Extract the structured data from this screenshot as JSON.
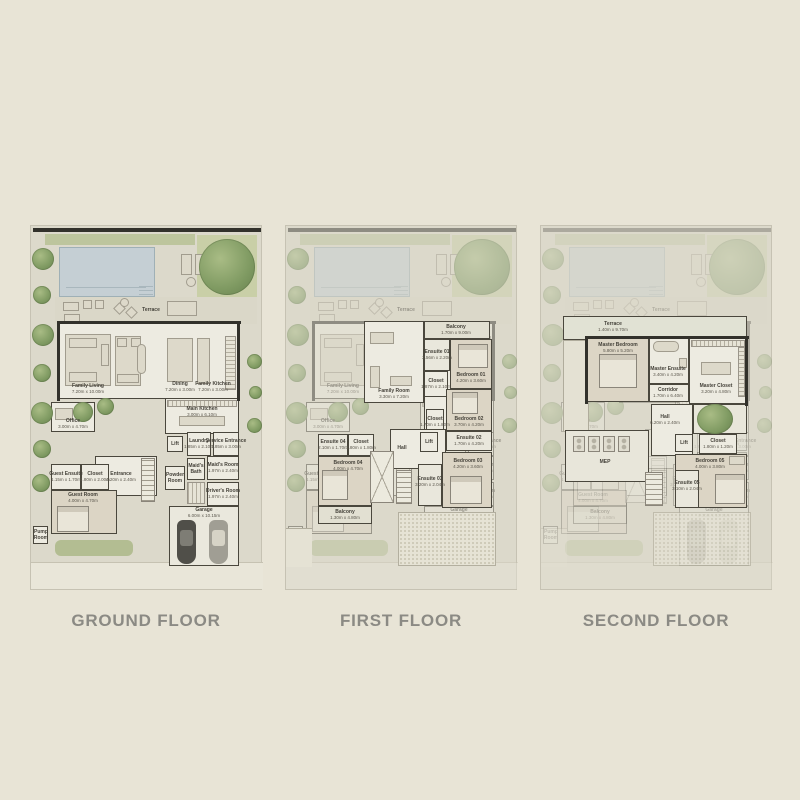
{
  "palette": {
    "page_bg": "#e8e4d6",
    "title_color": "#8b8a84",
    "pool_blue": "#c5cfd4",
    "grass_green": "#c9cfa7",
    "tree_green": "#7f9a62",
    "wall_black": "#32312b",
    "floor_white": "#edebe1",
    "bedroom_tan": "#dcd5c5"
  },
  "floors": {
    "ground": {
      "title": "GROUND FLOOR",
      "rooms": {
        "terrace": {
          "name": "Terrace"
        },
        "family_living": {
          "name": "Family Living",
          "dims": "7.20m x 10.00m"
        },
        "dining": {
          "name": "Dining",
          "dims": "7.20m x 3.00m"
        },
        "family_kitchen": {
          "name": "Family Kitchen",
          "dims": "7.20m x 3.00m"
        },
        "main_kitchen": {
          "name": "Main Kitchen",
          "dims": "3.00m x 6.10m"
        },
        "office": {
          "name": "Office",
          "dims": "3.00m x 4.70m"
        },
        "entrance": {
          "name": "Entrance",
          "dims": "4.20m x 2.40m"
        },
        "guest_ensuite": {
          "name": "Guest Ensuite",
          "dims": "1.15m x 1.70m"
        },
        "closet": {
          "name": "Closet",
          "dims": "1.80m x 2.00m"
        },
        "guest_room": {
          "name": "Guest Room",
          "dims": "4.00m x 4.70m"
        },
        "lift": {
          "name": "Lift"
        },
        "laundry": {
          "name": "Laundry",
          "dims": "1.85m x 2.10m"
        },
        "service_entrance": {
          "name": "Service Entrance",
          "dims": "1.85m x 3.00m"
        },
        "powder_room": {
          "name": "Powder Room",
          "dims": "1.40m x 2.10m"
        },
        "maids_bath": {
          "name": "Maid's Bath",
          "dims": "1.70m x 1.40m"
        },
        "maids_room": {
          "name": "Maid's Room",
          "dims": "1.97m x 2.40m"
        },
        "drivers_room": {
          "name": "Driver's Room",
          "dims": "1.97m x 2.40m"
        },
        "garage": {
          "name": "Garage",
          "dims": "6.00m x 10.15m"
        },
        "pump_room": {
          "name": "Pump Room"
        }
      }
    },
    "first": {
      "title": "FIRST FLOOR",
      "rooms": {
        "balcony_front": {
          "name": "Balcony",
          "dims": "1.70m x 9.00m"
        },
        "family_room": {
          "name": "Family Room",
          "dims": "3.30m x 7.20m"
        },
        "ensuite_01": {
          "name": "Ensuite 01",
          "dims": "2.56m x 2.20m"
        },
        "closet_01": {
          "name": "Closet",
          "dims": "1.87m x 2.10m"
        },
        "bedroom_01": {
          "name": "Bedroom 01",
          "dims": "4.20m x 3.60m"
        },
        "bedroom_02": {
          "name": "Bedroom 02",
          "dims": "3.70m x 4.20m"
        },
        "closet_02": {
          "name": "Closet",
          "dims": "1.70m x 1.80m"
        },
        "ensuite_02": {
          "name": "Ensuite 02",
          "dims": "1.70m x 4.20m"
        },
        "hall": {
          "name": "Hall"
        },
        "lift": {
          "name": "Lift"
        },
        "ensuite_03": {
          "name": "Ensuite 03",
          "dims": "3.20m x 2.04m"
        },
        "bedroom_03": {
          "name": "Bedroom 03",
          "dims": "4.20m x 3.60m"
        },
        "ensuite_04": {
          "name": "Ensuite 04",
          "dims": "2.10m x 1.70m"
        },
        "closet_04": {
          "name": "Closet",
          "dims": "1.80m x 1.80m"
        },
        "bedroom_04": {
          "name": "Bedroom 04",
          "dims": "4.00m x 4.70m"
        },
        "balcony_rear": {
          "name": "Balcony",
          "dims": "1.30m x 4.80m"
        }
      }
    },
    "second": {
      "title": "SECOND FLOOR",
      "rooms": {
        "terrace": {
          "name": "Terrace",
          "dims": "1.40m x 9.70m"
        },
        "master_bedroom": {
          "name": "Master Bedroom",
          "dims": "5.80m x 5.20m"
        },
        "master_ensuite": {
          "name": "Master Ensuite",
          "dims": "3.40m x 4.20m"
        },
        "corridor": {
          "name": "Corridor",
          "dims": "1.70m x 6.40m"
        },
        "master_closet": {
          "name": "Master Closet",
          "dims": "3.20m x 4.80m"
        },
        "hall": {
          "name": "Hall",
          "dims": "6.20m x 2.40m"
        },
        "lift": {
          "name": "Lift"
        },
        "closet_05": {
          "name": "Closet",
          "dims": "1.80m x 1.20m"
        },
        "bedroom_05": {
          "name": "Bedroom 05",
          "dims": "4.00m x 3.80m"
        },
        "ensuite_05": {
          "name": "Ensuite 05",
          "dims": "3.10m x 2.04m"
        },
        "mep": {
          "name": "MEP"
        }
      }
    }
  }
}
